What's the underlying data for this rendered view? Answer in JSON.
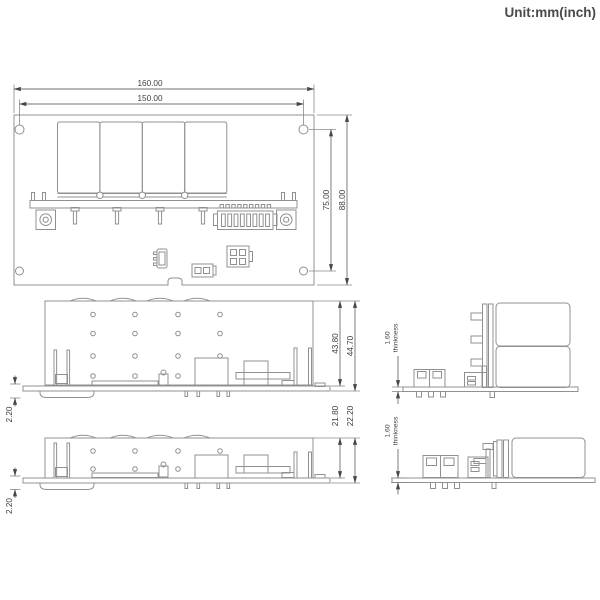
{
  "unit_label": "Unit:mm(inch)",
  "top_view": {
    "overall_width": "160.00",
    "hole_pitch_x": "150.00",
    "hole_pitch_y": "75.00",
    "overall_depth": "88.00"
  },
  "side_view_covered": {
    "height_components": "43.80",
    "height_total": "44.70",
    "standoff": "2.20"
  },
  "side_view_low": {
    "height_components": "21.80",
    "height_total": "22.20",
    "standoff": "2.20"
  },
  "end_view_covered": {
    "pcb_thickness": "1.60",
    "thickness_word": "thinkness"
  },
  "end_view_low": {
    "pcb_thickness": "1.60",
    "thickness_word": "thinkness"
  }
}
